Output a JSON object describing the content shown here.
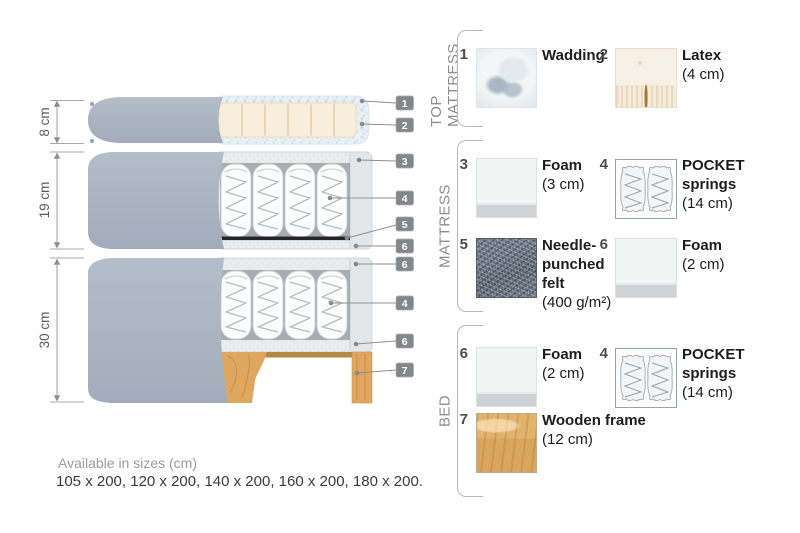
{
  "diagram": {
    "dimensions": [
      {
        "label": "8 cm"
      },
      {
        "label": "19 cm"
      },
      {
        "label": "30 cm"
      }
    ],
    "callouts": [
      "1",
      "2",
      "3",
      "4",
      "5",
      "6",
      "6",
      "4",
      "6",
      "7"
    ]
  },
  "legend": {
    "groups": [
      {
        "label": "TOP MATTRESS",
        "items": [
          {
            "num": "1",
            "name": "Wadding",
            "size": ""
          },
          {
            "num": "2",
            "name": "Latex",
            "size": "(4 cm)"
          }
        ]
      },
      {
        "label": "MATTRESS",
        "items": [
          {
            "num": "3",
            "name": "Foam",
            "size": "(3 cm)"
          },
          {
            "num": "4",
            "name": "POCKET springs",
            "size": "(14 cm)"
          },
          {
            "num": "5",
            "name": "Needle-punched felt",
            "size": "(400 g/m²)"
          },
          {
            "num": "6",
            "name": "Foam",
            "size": "(2 cm)"
          }
        ]
      },
      {
        "label": "BED",
        "items": [
          {
            "num": "6",
            "name": "Foam",
            "size": "(2 cm)"
          },
          {
            "num": "4",
            "name": "POCKET springs",
            "size": "(14 cm)"
          },
          {
            "num": "7",
            "name": "Wooden frame",
            "size": "(12 cm)"
          }
        ]
      }
    ]
  },
  "footer": {
    "sizes_title": "Available in sizes (cm)",
    "sizes_list": "105 x 200, 120 x 200, 140 x 200, 160 x 200, 180 x 200."
  },
  "colors": {
    "fabric": "#aab4c1",
    "latex": "#f8eedb",
    "wadding": "#e9eef2",
    "felt": "#626b78",
    "wood": "#dda660",
    "badge": "#84878a",
    "foam": "#e9eced"
  }
}
